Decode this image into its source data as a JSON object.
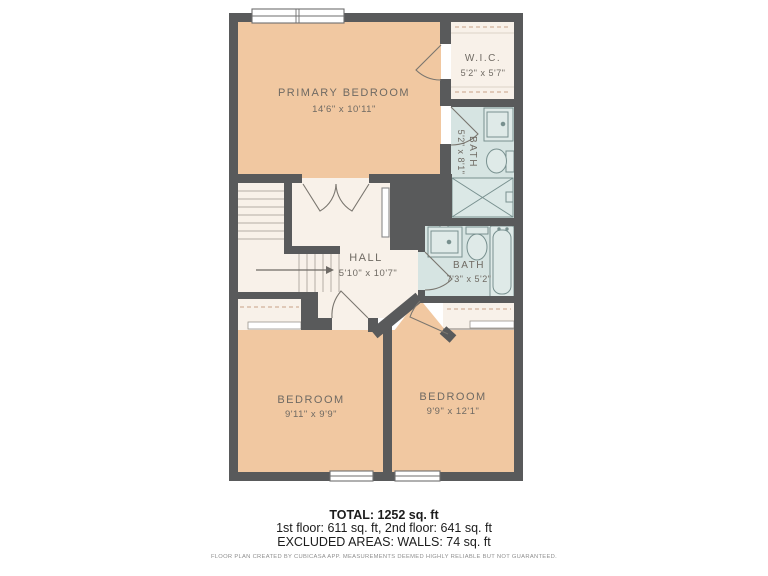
{
  "plan": {
    "rooms": [
      {
        "name": "PRIMARY BEDROOM",
        "dims": "14'6\" x 10'11\""
      },
      {
        "name": "W.I.C.",
        "dims": "5'2\" x 5'7\""
      },
      {
        "name": "BATH",
        "dims": "5'2\" x 8'1\""
      },
      {
        "name": "HALL",
        "dims": "5'10\" x 10'7\""
      },
      {
        "name": "BATH",
        "dims": "7'3\" x 5'2\""
      },
      {
        "name": "BEDROOM",
        "dims": "9'11\" x 9'9\""
      },
      {
        "name": "BEDROOM",
        "dims": "9'9\" x 12'1\""
      }
    ],
    "colors": {
      "wall": "#595a5b",
      "bedroom_fill": "#f1c8a1",
      "hall_fill": "#f8f1e9",
      "bath_fill": "#d6e4e2"
    }
  },
  "summary": {
    "total": "TOTAL: 1252 sq. ft",
    "floors": "1st floor: 611 sq. ft, 2nd floor: 641 sq. ft",
    "excluded": "EXCLUDED AREAS: WALLS: 74 sq. ft",
    "disclaimer": "FLOOR PLAN CREATED BY CUBICASA APP. MEASUREMENTS DEEMED HIGHLY RELIABLE BUT NOT GUARANTEED."
  }
}
